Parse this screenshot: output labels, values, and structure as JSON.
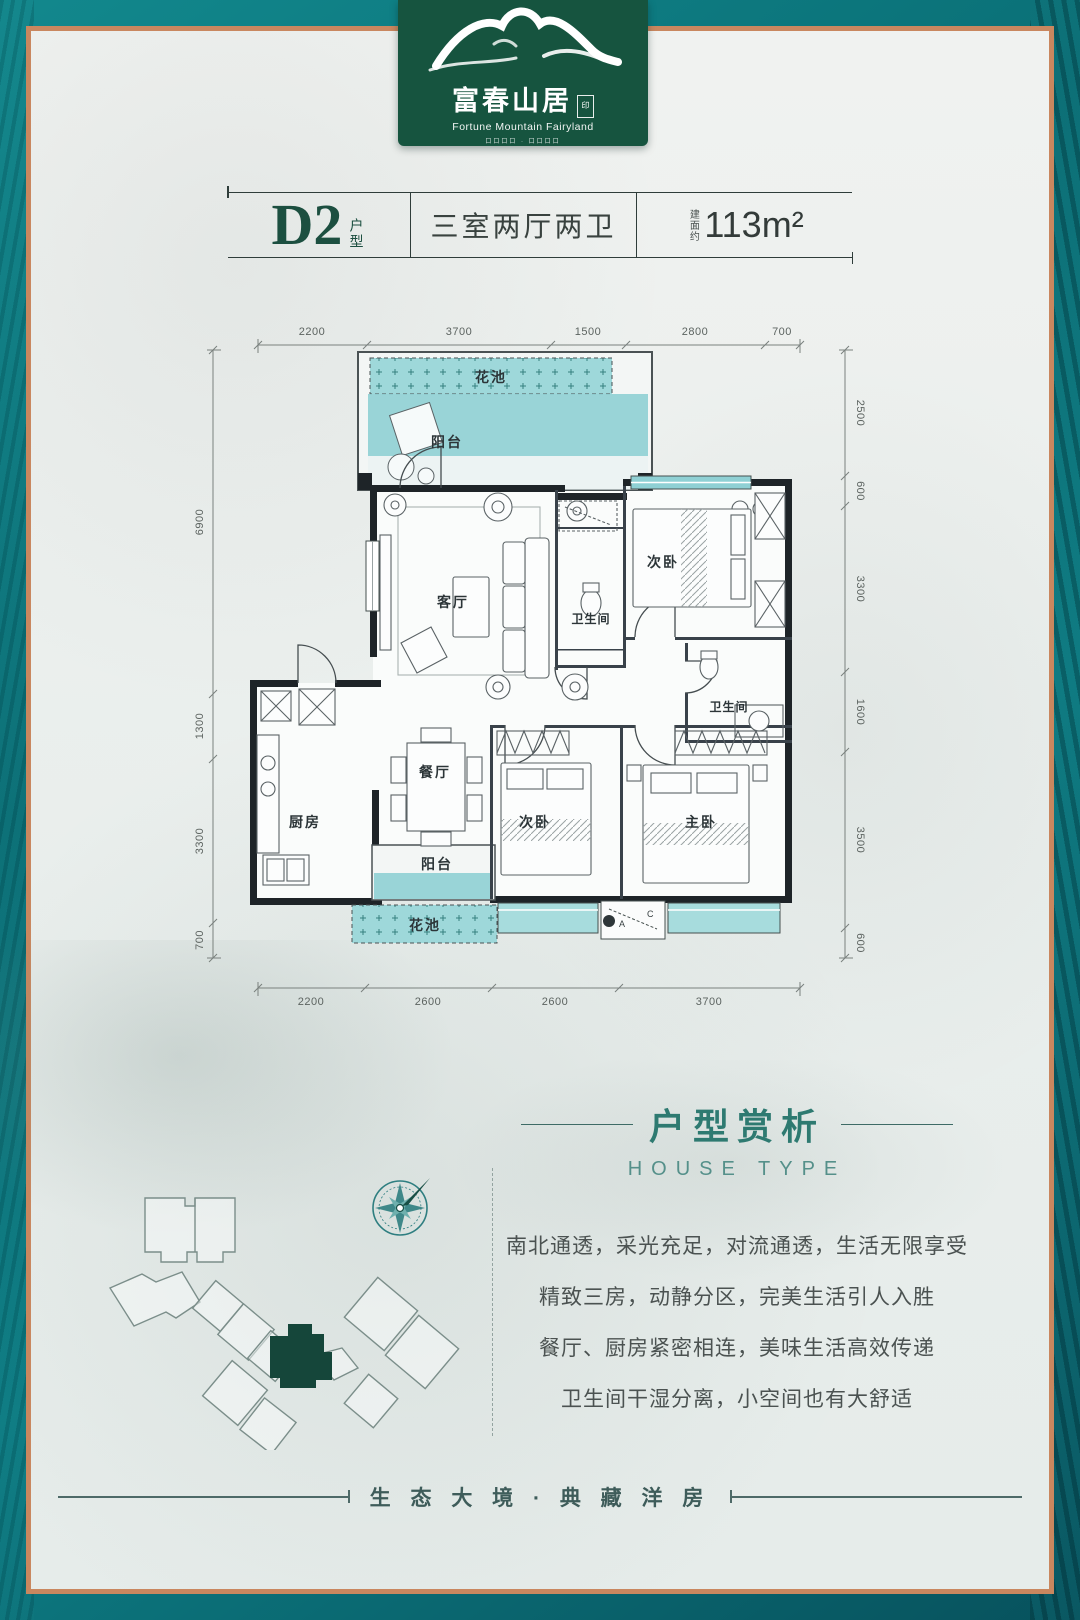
{
  "logo": {
    "brand_cn": "富春山居",
    "brand_en": "Fortune Mountain Fairyland",
    "seal": "印",
    "tagline": "口口口口 · 口口口口"
  },
  "title_bar": {
    "unit": "D2",
    "unit_suffix": "户型",
    "layout": "三室两厅两卫",
    "area_prefix": "建面约",
    "area": "113m²"
  },
  "plan": {
    "labels": {
      "flower": "花池",
      "balcony": "阳台",
      "living": "客厅",
      "bath": "卫生间",
      "bedroom2": "次卧",
      "master": "主卧",
      "dining": "餐厅",
      "kitchen": "厨房",
      "ac_a": "A",
      "ac_c": "C"
    },
    "dims": {
      "top": [
        "2200",
        "3700",
        "1500",
        "2800",
        "700"
      ],
      "bottom": [
        "2200",
        "2600",
        "2600",
        "3700"
      ],
      "left": [
        "6900",
        "1300",
        "3300",
        "700"
      ],
      "right": [
        "2500",
        "600",
        "3300",
        "1600",
        "3500",
        "600"
      ]
    }
  },
  "analysis": {
    "title": "户型赏析",
    "subtitle": "HOUSE TYPE",
    "lines": [
      "南北通透，采光充足，对流通透，生活无限享受",
      "精致三房，动静分区，完美生活引人入胜",
      "餐厅、厨房紧密相连，美味生活高效传递",
      "卫生间干湿分离，小空间也有大舒适"
    ]
  },
  "footer": {
    "slogan": "生 态 大 境 · 典 藏 洋 房"
  },
  "colors": {
    "teal_frame": "#0b747b",
    "copper_frame": "#c9875f",
    "badge_green": "#16543f",
    "plan_teal": "#8fd0d4",
    "flowerbed_teal": "#9ed8da",
    "title_green": "#1c4f40",
    "heading_teal": "#2e7a71",
    "site_highlight": "#15463a"
  }
}
